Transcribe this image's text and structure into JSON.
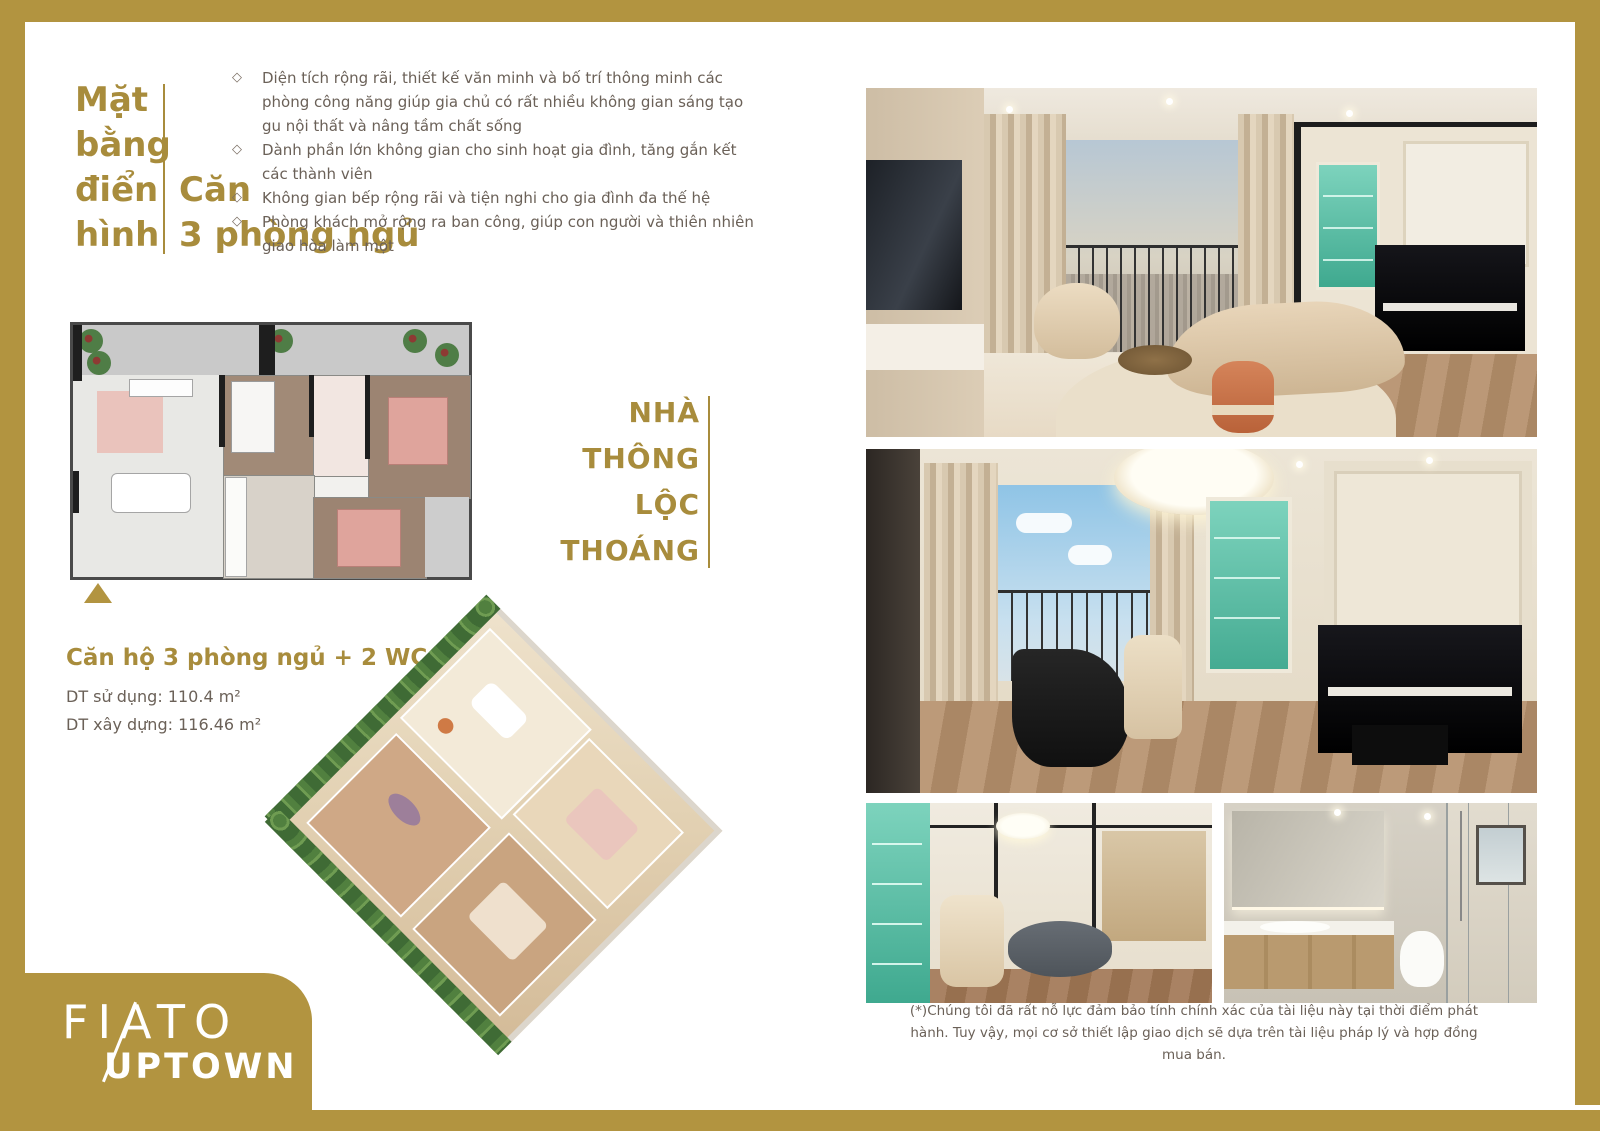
{
  "header": {
    "title_left_lines": [
      "Mặt",
      "bằng",
      "điển",
      "hình"
    ],
    "title_right_line1": "Căn",
    "title_right_line2": "3 phòng ngủ"
  },
  "features": {
    "bullet_glyph": "◇",
    "items": [
      "Diện tích rộng rãi, thiết kế văn minh và bố trí thông minh các phòng công năng giúp gia chủ có rất nhiều không gian sáng tạo gu nội thất và nâng tầm chất sống",
      "Dành phần lớn không gian cho sinh hoạt gia đình, tăng gắn kết các thành viên",
      "Không gian bếp rộng rãi và tiện nghi cho gia đình đa thế hệ",
      "Phòng khách mở rộng ra ban công, giúp con người và thiên nhiên giao hòa làm một"
    ]
  },
  "tagline": {
    "lines": [
      "NHÀ",
      "THÔNG",
      "LỘC",
      "THOÁNG"
    ]
  },
  "unit_info": {
    "title": "Căn hộ 3 phòng ngủ + 2 WC",
    "usable_area": "DT sử dụng: 110.4 m²",
    "construction_area": "DT xây dựng: 116.46 m²"
  },
  "disclaimer": "(*)Chúng tôi đã rất nỗ lực đảm bảo tính chính xác của tài liệu này tại thời điểm phát hành. Tuy vậy, mọi cơ sở thiết lập giao dịch sẽ dựa trên tài liệu pháp lý và hợp đồng mua bán.",
  "brand": {
    "name_top": "FIATO",
    "name_bottom": "UPTOWN"
  },
  "colors": {
    "gold_frame": "#b29440",
    "gold_text": "#a88c3c",
    "body_text": "#6b6158",
    "teal_accent": "#4fb89d",
    "pouf_orange": "#c96f3f",
    "wood_floor": "#b29171",
    "bed_pink": "#dfa49c"
  }
}
